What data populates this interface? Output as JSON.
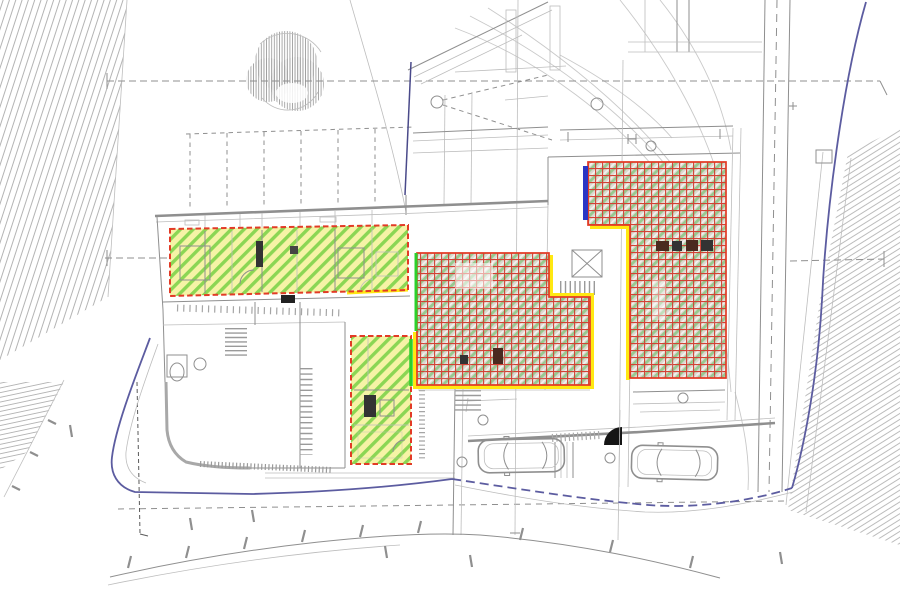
{
  "page": {
    "description": "Architectural CAD site and floor plan: existing building at top, three new dwelling units highlighted (two green diagonal-hatched areas, two red cross-hatched areas), two parked cars, one tree, blue property boundary, hatched slope areas at corners. No legible text labels in the drawing.",
    "background": "#ffffff"
  },
  "colors": {
    "background": "#ffffff",
    "cad": "#8f8f8f",
    "cad_light": "#bdbdbd",
    "cad_dark": "#5a5a5a",
    "contour": "#c9c9c9",
    "hatch_gray": "#b4b4b4",
    "green_fill": "#f6f3a6",
    "green_stripe": "#78d145",
    "green_edge": "#2bd12b",
    "red_outline": "#e23b26",
    "red_grid": "#d24234",
    "cross_base": "#dbd9d0",
    "cross_stripe": "#97c98f",
    "yellow": "#ffe812",
    "blue_boundary": "#5c5ca0",
    "blue_marker": "#2a35c4",
    "navy": "#4a4a8a",
    "tree_hatch": "#a0a0a0",
    "black": "#161616"
  },
  "inventory": {
    "trees": 1,
    "cars": 2,
    "green_hatched_units": 2,
    "red_crosshatched_units": 2,
    "staircases": 4,
    "elevators": 1,
    "door_swings": 3,
    "visible_text_labels": 0
  }
}
